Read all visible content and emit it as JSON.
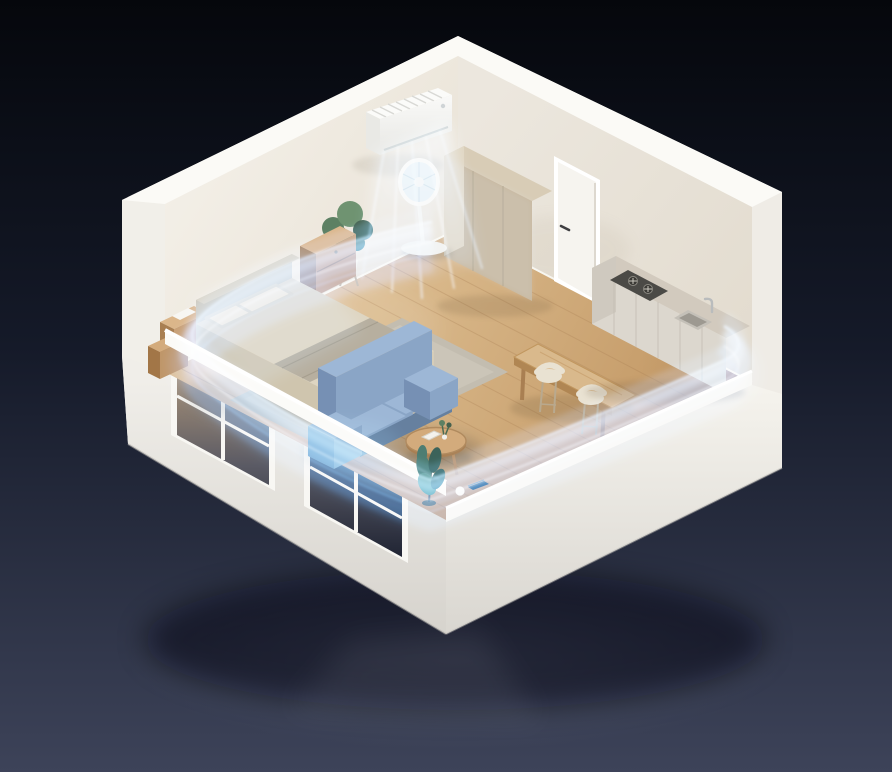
{
  "scene": {
    "description": "Isometric cutaway studio room with wall air conditioner and circulating blue airflow visualization",
    "background": {
      "top": "#05070c",
      "mid": "#151a29",
      "bottom": "#3d4359",
      "glow": "#aab4c8"
    },
    "room": {
      "wall_nw": "#f3efe7",
      "wall_ne": "#ece7de",
      "wall_top": "#fbfaf6",
      "ext_bright": "#f5f3ed",
      "ext_shade": "#d8d5cf",
      "end_cap": "#efece6",
      "floor_light": "#e4c89d",
      "floor_dark": "#c49a67",
      "plank": "#a87f54",
      "glass_top": "#c2a47e",
      "glass_bottom": "#1b2030",
      "skirting": "#faf8f3"
    },
    "furniture": {
      "rug": "#c3bdb0",
      "rug_inner": "#cdc7ba",
      "bed_linen": "#ded5c1",
      "bed_side": "#cfc5ae",
      "bed_foot": "#d6cdb8",
      "bed_stripe": "#b2ab9b",
      "pillow": "#ece4d0",
      "headboard": "#cdc6b8",
      "sofa_light": "#9db7d6",
      "sofa_mid": "#8aa5c6",
      "sofa_dark": "#7690b4",
      "sofa_deep": "#66809f",
      "wood_light": "#dbb68a",
      "wood_mid": "#c9a074",
      "wood_dark": "#a97f52",
      "wardrobe_front": "#c8b89e",
      "wardrobe_top": "#d8ccb6",
      "wardrobe_side": "#e0d6c2",
      "cabinet_top": "#d2cabe",
      "cabinet_front": "#dcd7ce",
      "cabinet_end": "#cfc9bf",
      "stove": "#4b4a46",
      "sink": "#c4c0b8",
      "sink_basin": "#9d9991",
      "door": "#f6f4ef",
      "handle": "#3f3f41",
      "appliance_white": "#fafafa",
      "screen_navy": "#2c3a55",
      "plant_green": "#5d8063",
      "plant_dark": "#46614d",
      "plant_teal": "#4e7d72",
      "pot_white": "#f2f1ed"
    },
    "airflow": {
      "core": "#57a8ec",
      "light": "#a8d7f9",
      "deep": "#2e7fd6",
      "pale": "#ddf0fe"
    },
    "objects": [
      "air-conditioner",
      "pedestal-fan",
      "wardrobe",
      "door",
      "kitchen-counter",
      "gas-stove",
      "kitchen-sink",
      "faucet",
      "dining-table",
      "bar-stool",
      "sofa",
      "coffee-table",
      "bed",
      "pillows",
      "headboard",
      "rug",
      "nightstand",
      "side-cabinet",
      "potted-plant",
      "floor-plant",
      "smart-device",
      "window",
      "airflow-streams"
    ]
  }
}
